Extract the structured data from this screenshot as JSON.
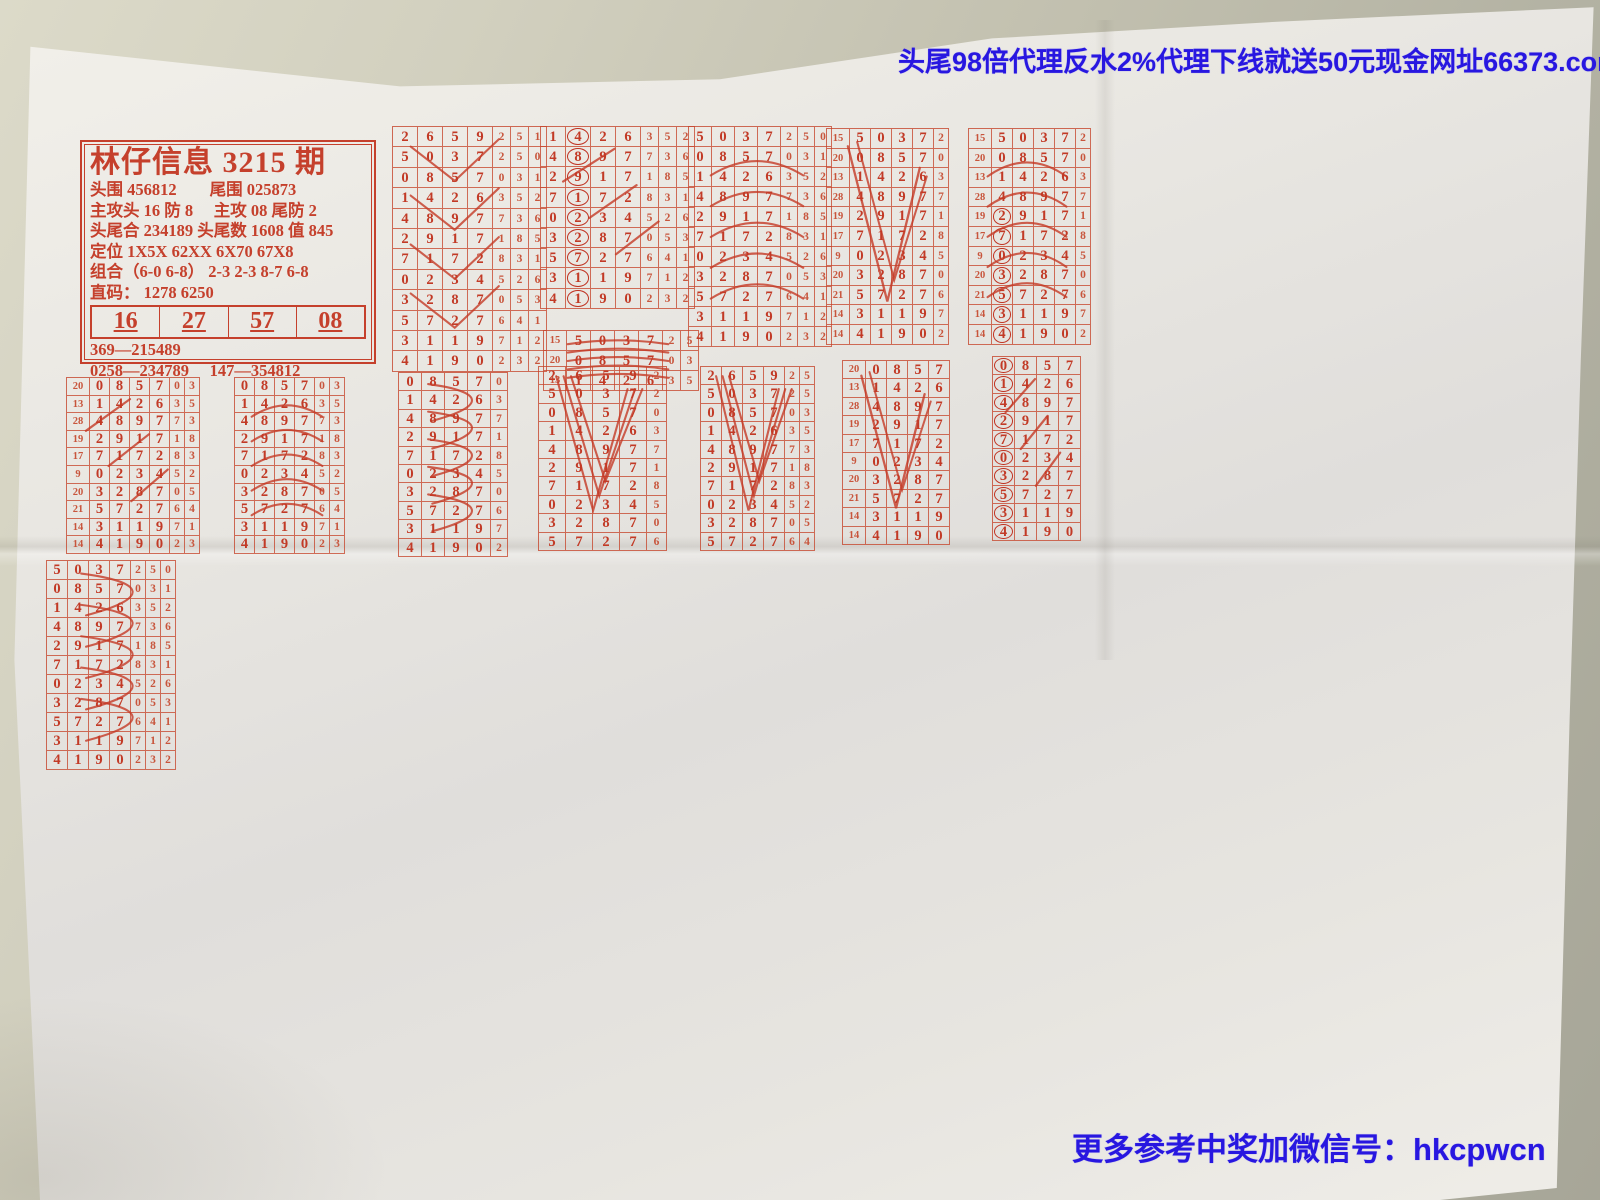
{
  "banners": {
    "top": "头尾98倍代理反水2%代理下线就送50元现金网址66373.com",
    "bottom": "更多参考中奖加微信号：hkcpwcn"
  },
  "watermarks": [
    {
      "text": "七星彩排列五赔99.5 代理反水0.5",
      "x": 470,
      "y": 660,
      "rot": -21,
      "size": 52,
      "hollow": false
    },
    {
      "text": "99222123。com",
      "x": 545,
      "y": 1035,
      "rot": -31,
      "size": 62,
      "hollow": false
    },
    {
      "text": "www.hkcpw。com",
      "x": 92,
      "y": 186,
      "rot": 43,
      "size": 46,
      "hollow": true
    },
    {
      "text": "www.hkcpw。com",
      "x": 1098,
      "y": 790,
      "rot": 40,
      "size": 46,
      "hollow": true
    }
  ],
  "info_box": {
    "title": "林仔信息 3215 期",
    "lines": [
      "头围 456812　　尾围 025873",
      "主攻头 16 防 8　 主攻 08 尾防 2",
      "头尾合 234189 头尾数 1608 值 845",
      "定位 1X5X  62XX  6X70  67X8",
      "组合（6-0 6-8）  2-3 2-3 8-7 6-8",
      "直码： 1278  6250"
    ],
    "picks": [
      "16",
      "27",
      "57",
      "08"
    ],
    "bottom_lines": [
      "369—215489",
      "0258—234789　 147—354812"
    ]
  },
  "draws": {
    "index": [
      "19",
      "17",
      "22",
      "15",
      "20",
      "13",
      "28",
      "19",
      "17",
      "9",
      "20",
      "21",
      "14",
      "14"
    ],
    "rows": [
      "3907723",
      "5354253",
      "2659251",
      "5037250",
      "0857031",
      "1426352",
      "4897736",
      "2917185",
      "7172831",
      "0234526",
      "3287053",
      "5727641",
      "3119712",
      "4190232"
    ]
  },
  "blocks": [
    {
      "x": 392,
      "y": 126,
      "cw": 24,
      "ch": 20.4,
      "start": 2,
      "n": 12,
      "cols": 7,
      "scrib": "w"
    },
    {
      "x": 540,
      "y": 126,
      "cw": 24,
      "ch": 20.2,
      "start": 5,
      "n": 9,
      "cols": 7,
      "circle": 1,
      "scrib": "diagS"
    },
    {
      "x": 543,
      "y": 330,
      "cw": 23,
      "ch": 20,
      "start": 3,
      "n": 3,
      "cols": 6,
      "idx": true,
      "scrib": "arc"
    },
    {
      "x": 688,
      "y": 126,
      "cw": 22,
      "ch": 20,
      "start": 3,
      "n": 11,
      "cols": 7,
      "scrib": "arc"
    },
    {
      "x": 826,
      "y": 128,
      "cw": 20,
      "ch": 19.6,
      "start": 3,
      "n": 11,
      "cols": 5,
      "idx": true,
      "scrib": "v"
    },
    {
      "x": 968,
      "y": 128,
      "cw": 20,
      "ch": 19.6,
      "start": 3,
      "n": 11,
      "cols": 5,
      "idx": true,
      "circle": 0,
      "circleFrom": 4,
      "scrib": "arc"
    },
    {
      "x": 66,
      "y": 377,
      "cw": 19,
      "ch": 17.6,
      "start": 4,
      "n": 10,
      "cols": 6,
      "idx": true,
      "scrib": "diagS"
    },
    {
      "x": 234,
      "y": 377,
      "cw": 19,
      "ch": 17.6,
      "start": 4,
      "n": 10,
      "cols": 6,
      "scrib": "arc"
    },
    {
      "x": 398,
      "y": 372,
      "cw": 22,
      "ch": 18.4,
      "start": 4,
      "n": 10,
      "cols": 5,
      "scrib": "fan"
    },
    {
      "x": 538,
      "y": 366,
      "cw": 26,
      "ch": 18.4,
      "start": 2,
      "n": 10,
      "cols": 5,
      "scrib": "vv"
    },
    {
      "x": 700,
      "y": 366,
      "cw": 20,
      "ch": 18.4,
      "start": 2,
      "n": 10,
      "cols": 6,
      "scrib": "vv"
    },
    {
      "x": 842,
      "y": 360,
      "cw": 20,
      "ch": 18.4,
      "start": 4,
      "n": 10,
      "cols": 4,
      "idx": true,
      "scrib": "v"
    },
    {
      "x": 992,
      "y": 356,
      "cw": 21,
      "ch": 18.4,
      "start": 4,
      "n": 10,
      "cols": 4,
      "circle": 0,
      "scrib": "diagS"
    },
    {
      "x": 46,
      "y": 560,
      "cw": 20,
      "ch": 19,
      "start": 3,
      "n": 11,
      "cols": 7,
      "scrib": "fan"
    },
    {
      "x": 208,
      "y": 548,
      "cw": 20,
      "ch": 19,
      "start": 2,
      "n": 13,
      "cols": 5,
      "idx": true,
      "circle": 0,
      "circleFrom": 3,
      "scrib": "fan"
    },
    {
      "x": 388,
      "y": 556,
      "cw": 22,
      "ch": 19.6,
      "start": 3,
      "n": 12,
      "cols": 6,
      "scrib": "fan"
    },
    {
      "x": 556,
      "y": 558,
      "cw": 25,
      "ch": 20.6,
      "start": 2,
      "n": 12,
      "cols": 7,
      "big": true,
      "scrib": "diag"
    },
    {
      "x": 744,
      "y": 560,
      "cw": 21,
      "ch": 20.4,
      "start": 8,
      "n": 6,
      "cols": 5,
      "idx": true,
      "circle": 0,
      "scrib": "v"
    },
    {
      "x": 1032,
      "y": 546,
      "cw": 22,
      "ch": 20,
      "start": 11,
      "n": 3,
      "cols": 7,
      "idx": true,
      "scrib": "arc"
    },
    {
      "x": 36,
      "y": 816,
      "cw": 26,
      "ch": 21.4,
      "start": 0,
      "n": 14,
      "cols": 7,
      "big": true,
      "circle": 0,
      "circleFrom": 3,
      "scrib": "diag"
    },
    {
      "x": 232,
      "y": 824,
      "cw": 20,
      "ch": 21,
      "start": 1,
      "n": 13,
      "cols": 6,
      "idx": true,
      "scrib": "vv"
    },
    {
      "x": 380,
      "y": 832,
      "cw": 21,
      "ch": 20.6,
      "start": 1,
      "n": 13,
      "cols": 6,
      "idx": true,
      "circle": 0,
      "circleFrom": 5,
      "scrib": "v"
    },
    {
      "x": 528,
      "y": 878,
      "cw": 23,
      "ch": 20.6,
      "start": 3,
      "n": 11,
      "cols": 7,
      "scrib": "v"
    },
    {
      "x": 728,
      "y": 898,
      "cw": 21,
      "ch": 20.2,
      "start": 4,
      "n": 10,
      "cols": 6,
      "idx": true,
      "scrib": "v"
    },
    {
      "x": 906,
      "y": 788,
      "cw": 20,
      "ch": 20,
      "start": 1,
      "n": 13,
      "cols": 5,
      "idx": true,
      "scrib": "fan"
    },
    {
      "x": 1042,
      "y": 902,
      "cw": 21,
      "ch": 20.2,
      "start": 6,
      "n": 8,
      "cols": 5,
      "idx": true,
      "scrib": "arc"
    }
  ],
  "labels": [
    {
      "t": "单火",
      "x": 394,
      "y": 378,
      "r": -8,
      "s": 21
    },
    {
      "t": "单双跟",
      "x": 560,
      "y": 300,
      "r": -5,
      "s": 19
    },
    {
      "t": "三相合49",
      "x": 848,
      "y": 348,
      "r": -7,
      "s": 19
    },
    {
      "t": "七位单双",
      "x": 806,
      "y": 332,
      "r": -6,
      "s": 17
    },
    {
      "t": "双火",
      "x": 1122,
      "y": 338,
      "r": -8,
      "s": 17
    },
    {
      "t": "⑯次",
      "x": 252,
      "y": 512,
      "r": -5,
      "s": 21
    },
    {
      "t": "一位双胆",
      "x": 580,
      "y": 518,
      "r": -4,
      "s": 19
    },
    {
      "t": "尾大",
      "x": 232,
      "y": 556,
      "r": -6,
      "s": 17
    },
    {
      "t": "双飞",
      "x": 1000,
      "y": 548,
      "r": -5,
      "s": 19
    },
    {
      "t": "单选跟",
      "x": 98,
      "y": 558,
      "r": -5,
      "s": 17
    },
    {
      "t": "0258胆",
      "x": 52,
      "y": 780,
      "r": -4,
      "s": 17
    },
    {
      "t": "96次",
      "x": 412,
      "y": 800,
      "r": -6,
      "s": 17
    },
    {
      "t": "刀头",
      "x": 584,
      "y": 812,
      "r": -6,
      "s": 19
    },
    {
      "t": "⑯次",
      "x": 756,
      "y": 690,
      "r": -5,
      "s": 19
    },
    {
      "t": "中位合单",
      "x": 1060,
      "y": 612,
      "r": -5,
      "s": 17
    },
    {
      "t": "尾B",
      "x": 1196,
      "y": 578,
      "r": -5,
      "s": 19
    },
    {
      "t": "长粉车",
      "x": 1262,
      "y": 800,
      "r": -6,
      "s": 17
    },
    {
      "t": "对公657跟",
      "x": 44,
      "y": 1122,
      "r": -5,
      "s": 16
    },
    {
      "t": "尾4",
      "x": 262,
      "y": 1108,
      "r": -5,
      "s": 16
    },
    {
      "t": "双五粉3456",
      "x": 392,
      "y": 1108,
      "r": -4,
      "s": 15
    },
    {
      "t": "一般123456",
      "x": 560,
      "y": 1110,
      "r": -4,
      "s": 15
    },
    {
      "t": "单尾",
      "x": 776,
      "y": 1104,
      "r": -5,
      "s": 16
    },
    {
      "t": "0258走六相",
      "x": 912,
      "y": 1052,
      "r": -4,
      "s": 15
    },
    {
      "t": "90上26全",
      "x": 1058,
      "y": 1072,
      "r": -4,
      "s": 15
    },
    {
      "t": "长条行",
      "x": 1296,
      "y": 1120,
      "r": -5,
      "s": 15
    },
    {
      "t": "、9",
      "x": 192,
      "y": 84,
      "r": 10,
      "s": 15
    }
  ],
  "charts": [
    {
      "name": "tail-chart-1",
      "x": 1128,
      "y": 128,
      "w": 432,
      "rh": 19.8,
      "bigIdx": true,
      "sweep": "big",
      "rows": [
        {
          "i": "22",
          "d": "",
          "t": [
            [
              0.05,
              0.66,
              1.3
            ]
          ]
        },
        {
          "i": "15",
          "d": "",
          "t": [
            [
              0.3,
              1,
              8.5
            ]
          ]
        },
        {
          "i": "20",
          "d": "",
          "t": [
            [
              0.3,
              0.7,
              1.3
            ],
            [
              0.5,
              0.97,
              4
            ]
          ]
        },
        {
          "i": "13",
          "d": "",
          "t": [
            [
              0.33,
              1,
              8
            ]
          ]
        },
        {
          "i": "28",
          "d": "4",
          "t": [
            [
              0.3,
              0.72,
              1.3
            ]
          ]
        },
        {
          "i": "19",
          "d": "2",
          "t": [
            [
              0.28,
              0.7,
              1.3
            ]
          ]
        },
        {
          "i": "17",
          "d": "7",
          "t": [
            [
              0.34,
              1,
              5.5
            ]
          ]
        },
        {
          "i": "9",
          "d": "0",
          "t": [
            [
              0.36,
              0.72,
              1.3
            ],
            [
              0.42,
              0.8,
              1.3
            ]
          ]
        },
        {
          "i": "20",
          "d": "3",
          "t": [
            [
              0.3,
              0.78,
              4.5
            ],
            [
              0.36,
              0.62,
              1.3
            ]
          ]
        },
        {
          "i": "21",
          "d": "5 7",
          "t": [
            [
              0.34,
              0.72,
              1.3
            ]
          ]
        },
        {
          "i": "14",
          "d": "3 1",
          "t": [
            [
              0.4,
              1,
              6.5
            ]
          ]
        },
        {
          "i": "14",
          "d": "4 1",
          "t": [
            [
              0.34,
              0.72,
              1.3
            ],
            [
              0.42,
              0.78,
              1.3
            ]
          ]
        },
        {
          "i": "",
          "d": "",
          "t": [
            [
              0.36,
              0.82,
              5
            ],
            [
              0.36,
              0.95,
              1.3
            ]
          ]
        }
      ]
    },
    {
      "name": "tail-chart-2",
      "x": 1130,
      "y": 374,
      "w": 430,
      "rh": 20.4,
      "bigIdx": false,
      "sweep": "curve",
      "rows": [
        {
          "i": "20",
          "d": "0 8",
          "t": [
            [
              0.42,
              0.8,
              6
            ],
            [
              0.4,
              1,
              1.3
            ]
          ]
        },
        {
          "i": "13",
          "d": "1 4 2",
          "t": [
            [
              0.48,
              0.97,
              1.3
            ],
            [
              0.52,
              0.9,
              1.3
            ]
          ]
        },
        {
          "i": "28",
          "d": "4 8 9",
          "t": [
            [
              0.46,
              1,
              7
            ]
          ]
        },
        {
          "i": "19",
          "d": "2 9 1",
          "t": [
            [
              0.5,
              0.96,
              1.3
            ]
          ]
        },
        {
          "i": "17",
          "d": "7 1 7",
          "t": [
            [
              0.42,
              0.97,
              1.3
            ],
            [
              0.46,
              0.9,
              1.3
            ]
          ]
        },
        {
          "i": "9",
          "d": "0 2 3 4",
          "t": [
            [
              0.46,
              0.99,
              1.3
            ]
          ]
        },
        {
          "i": "20",
          "d": "3 2 8 7",
          "t": [
            [
              0.5,
              1,
              4.5
            ],
            [
              0.44,
              0.9,
              1.3
            ]
          ]
        },
        {
          "i": "21",
          "d": "5 7 2 7",
          "t": [
            [
              0.46,
              1,
              6.5
            ]
          ]
        },
        {
          "i": "14",
          "d": "3 1 1 9",
          "t": [
            [
              0.44,
              0.8,
              4
            ],
            [
              0.5,
              0.97,
              1.3
            ]
          ]
        },
        {
          "i": "14",
          "d": "4 1 9 0",
          "t": [
            [
              0.46,
              0.97,
              1.3
            ],
            [
              0.42,
              0.72,
              1.3
            ]
          ]
        }
      ]
    },
    {
      "name": "tail-chart-3",
      "x": 1158,
      "y": 608,
      "w": 402,
      "rh": 20.6,
      "bigIdx": false,
      "sweep": "zigzag",
      "rows": [
        {
          "i": "13",
          "d": "1 4 2 6",
          "t": [
            [
              0.55,
              0.92,
              1.3
            ]
          ]
        },
        {
          "i": "28",
          "d": "4 8 9 7",
          "t": [
            [
              0.52,
              0.97,
              1.3
            ]
          ]
        },
        {
          "i": "19",
          "d": "2 9 1 7",
          "t": [
            [
              0.4,
              1,
              8
            ]
          ]
        },
        {
          "i": "17",
          "d": "7 1 7 2",
          "t": [
            [
              0.38,
              0.6,
              3
            ],
            [
              0.38,
              0.97,
              1.3
            ]
          ]
        },
        {
          "i": "9",
          "d": "0 2 3 4 5",
          "t": [
            [
              0.42,
              0.97,
              1.3
            ]
          ]
        },
        {
          "i": "20",
          "d": "3 2 8 7 0",
          "t": [
            [
              0.4,
              1,
              7.5
            ]
          ]
        },
        {
          "i": "21",
          "d": "5 7 2 7 6",
          "t": [
            [
              0.4,
              0.92,
              1.3
            ],
            [
              0.44,
              0.86,
              1.3
            ]
          ]
        },
        {
          "i": "14",
          "d": "3 1 1 9 7",
          "t": [
            [
              0.38,
              1,
              7
            ]
          ]
        },
        {
          "i": "14",
          "d": "4 1 9 0 2",
          "t": [
            [
              0.36,
              0.6,
              4
            ],
            [
              0.4,
              0.97,
              1.3
            ],
            [
              0.44,
              0.92,
              1.3
            ]
          ]
        }
      ]
    },
    {
      "name": "tail-chart-4",
      "x": 1246,
      "y": 802,
      "w": 314,
      "rh": 21,
      "bigIdx": false,
      "sweep": "none",
      "rows": [
        {
          "i": "",
          "d": "5",
          "t": [
            [
              0.2,
              1,
              1.3
            ],
            [
              0.26,
              1,
              5
            ]
          ]
        },
        {
          "i": "",
          "d": "3",
          "t": [
            [
              0.22,
              1,
              3
            ],
            [
              0.3,
              1,
              1.3
            ]
          ]
        },
        {
          "i": "",
          "d": "4",
          "t": [
            [
              0.18,
              1,
              1.3
            ]
          ]
        },
        {
          "i": "",
          "d": "",
          "t": [
            [
              0.15,
              1,
              2.5
            ],
            [
              0.2,
              0.9,
              1.3
            ]
          ]
        },
        {
          "i": "",
          "d": "",
          "t": [
            [
              0.18,
              0.95,
              1.3
            ]
          ]
        },
        {
          "i": "",
          "d": "",
          "t": [
            [
              0.2,
              1,
              1.3
            ],
            [
              0.24,
              1,
              1.3
            ],
            [
              0.28,
              1,
              1.3
            ]
          ]
        },
        {
          "i": "",
          "d": "",
          "t": [
            [
              0.3,
              1,
              6
            ],
            [
              0.26,
              1,
              1.3
            ]
          ]
        },
        {
          "i": "",
          "d": "",
          "t": [
            [
              0.25,
              1,
              1.3
            ],
            [
              0.3,
              1,
              1.3
            ]
          ]
        },
        {
          "i": "9",
          "d": "",
          "t": [
            [
              0.28,
              0.95,
              1.3
            ]
          ]
        },
        {
          "i": "20",
          "d": "",
          "t": [
            [
              0.3,
              1,
              12
            ]
          ]
        },
        {
          "i": "21",
          "d": "",
          "t": [
            [
              0.55,
              1,
              2.5
            ]
          ]
        },
        {
          "i": "14",
          "d": "",
          "t": [
            [
              0.3,
              1,
              1.3
            ],
            [
              0.35,
              1,
              4
            ]
          ]
        },
        {
          "i": "14",
          "d": "",
          "t": [
            [
              0.3,
              1,
              6
            ],
            [
              0.4,
              1,
              1.3
            ]
          ]
        },
        {
          "i": "",
          "d": "",
          "t": [
            [
              0.2,
              1,
              1.3
            ]
          ]
        },
        {
          "i": "",
          "d": "",
          "t": [
            [
              0.25,
              1,
              3
            ]
          ]
        }
      ]
    }
  ],
  "colors": {
    "red_ink": "#c23a26",
    "blue_ink": "#2817e0",
    "paper": "#e9e7e2",
    "table": "#b2b1a2"
  }
}
